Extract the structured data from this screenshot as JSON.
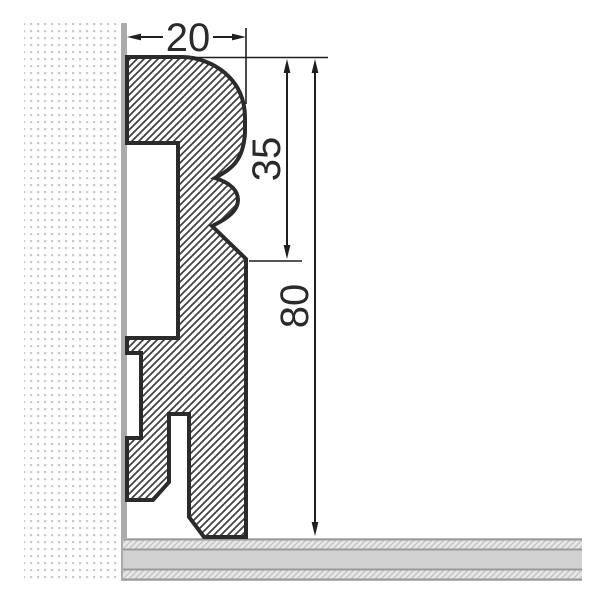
{
  "drawing": {
    "type": "technical-cross-section",
    "subject": "skirting-board-profile-on-wall-and-floor",
    "dimensions": {
      "profile_width": "20",
      "profile_upper_section_height": "35",
      "profile_total_height": "80"
    },
    "colors": {
      "background": "#ffffff",
      "profile_outline": "#2b2b2b",
      "profile_hatch": "#3f3f3f",
      "wall_dots": "#c9c9c9",
      "wall_edge_strip": "#ababab",
      "floor_fill": "#d2d2d2",
      "floor_border_lines": "#9a9a9a",
      "floor_hatch": "#bfbfbf",
      "dimension_lines": "#1f1f1f"
    }
  }
}
